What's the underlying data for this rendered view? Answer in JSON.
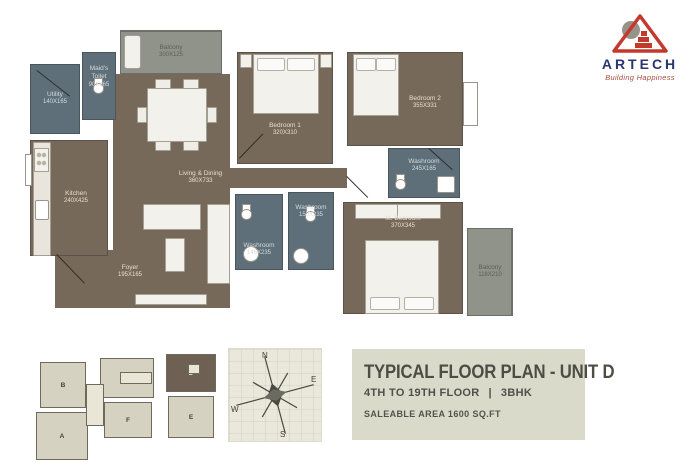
{
  "logo": {
    "brand": "ARTECH",
    "tagline": "Building Happiness"
  },
  "title_block": {
    "title": "TYPICAL FLOOR PLAN - UNIT D",
    "floor": "4TH TO 19TH FLOOR",
    "separator": "|",
    "unit_type": "3BHK",
    "area": "SALEABLE AREA 1600 SQ.FT"
  },
  "compass": {
    "n": "N",
    "e": "E",
    "s": "S",
    "w": "W"
  },
  "key_plan": {
    "units": [
      "B",
      "C",
      "D",
      "E",
      "F",
      "A"
    ],
    "highlighted": "D"
  },
  "rooms": {
    "utility": {
      "name": "Utility",
      "dims": "140X165"
    },
    "maids_toilet": {
      "name": "Maid's Toilet",
      "dims": "90X165"
    },
    "balcony_top": {
      "name": "Balcony",
      "dims": "300X125"
    },
    "kitchen": {
      "name": "Kitchen",
      "dims": "240X425"
    },
    "living_dining": {
      "name": "Living & Dining",
      "dims": "360X733"
    },
    "bedroom1": {
      "name": "Bedroom 1",
      "dims": "320X310"
    },
    "bedroom2": {
      "name": "Bedroom 2",
      "dims": "355X331"
    },
    "washroom_right": {
      "name": "Washroom",
      "dims": "245X165"
    },
    "washroom_mid": {
      "name": "Washroom",
      "dims": "150X235"
    },
    "washroom_left": {
      "name": "Washroom",
      "dims": "145X235"
    },
    "m_bedroom": {
      "name": "M. Bedroom",
      "dims": "370X345"
    },
    "foyer": {
      "name": "Foyer",
      "dims": "195X165"
    },
    "balcony_right": {
      "name": "Balcony",
      "dims": "118X210"
    }
  },
  "colors": {
    "room_brown": "#77695a",
    "wet_area_slate": "#5e6f79",
    "balcony_gray": "#90938a",
    "panel_bg": "#dadacb",
    "brand_red": "#c33a2d",
    "brand_navy": "#2b3570"
  }
}
